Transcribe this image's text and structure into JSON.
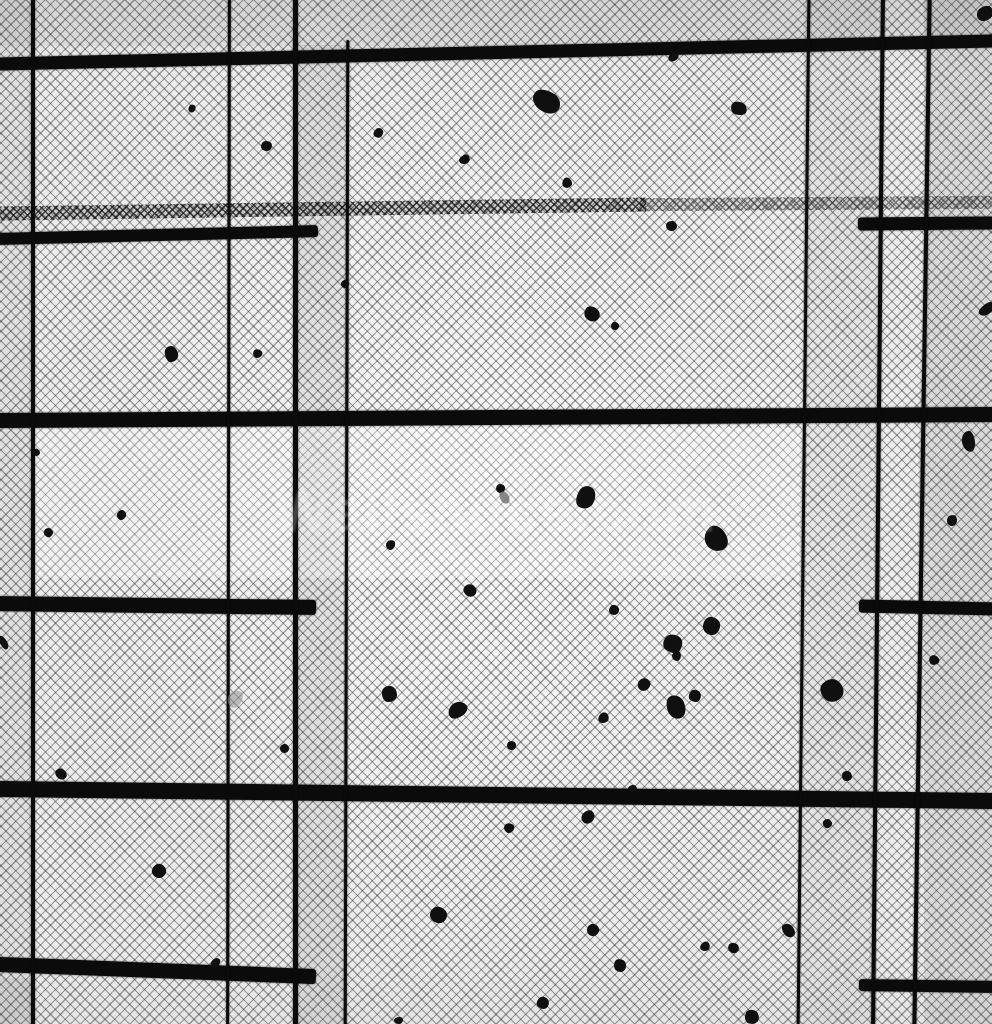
{
  "meta": {
    "description": "Black-and-white photograph looking up at a fine wire insect-screen ceiling with a grid of dark metal frame bars; scattered leaf and debris fragments rest on the mesh",
    "style": "monochrome photograph"
  },
  "palette": {
    "mesh_background": "#ececec",
    "mesh_line": "#2a2a2a",
    "bar": "#0b0b0b",
    "debris": "#101010",
    "debris_gray": "#7a7a7a",
    "watermark": "#ffffff"
  },
  "watermark": {
    "text": "Wallsauce.com",
    "opacity": 0.22
  },
  "frame": {
    "horizontal_bars": [
      {
        "x": -4,
        "y": 46,
        "w": 1000,
        "h": 13,
        "angle": -1.33
      },
      {
        "x": -4,
        "y": 229,
        "w": 322,
        "h": 12,
        "angle": -1.4
      },
      {
        "x": 858,
        "y": 217,
        "w": 140,
        "h": 13,
        "angle": -0.4
      },
      {
        "x": -4,
        "y": 409.5,
        "w": 1000,
        "h": 15,
        "angle": -0.35
      },
      {
        "x": -4,
        "y": 597.5,
        "w": 320,
        "h": 15,
        "angle": 0.7
      },
      {
        "x": 859,
        "y": 600.5,
        "w": 140,
        "h": 13,
        "angle": 1.2
      },
      {
        "x": -4,
        "y": 787,
        "w": 1000,
        "h": 16,
        "angle": 0.7
      },
      {
        "x": -4,
        "y": 962.5,
        "w": 320,
        "h": 15,
        "angle": 2.2
      },
      {
        "x": 859,
        "y": 980,
        "w": 140,
        "h": 12,
        "angle": 0.8
      }
    ],
    "vertical_bars": [
      {
        "x": 31,
        "y": -4,
        "w": 3.5,
        "h": 1032,
        "angle": 0
      },
      {
        "x": 226.5,
        "y": -4,
        "w": 3,
        "h": 1032,
        "angle": 0.1
      },
      {
        "x": 292.5,
        "y": -4,
        "w": 5,
        "h": 1032,
        "angle": 0
      },
      {
        "x": 345,
        "y": 40,
        "w": 3,
        "h": 988,
        "angle": 0.15
      },
      {
        "x": 802,
        "y": -4,
        "w": 3,
        "h": 1032,
        "angle": 0.6
      },
      {
        "x": 876,
        "y": -4,
        "w": 4,
        "h": 1032,
        "angle": 0.55
      },
      {
        "x": 920,
        "y": -4,
        "w": 3.5,
        "h": 1032,
        "angle": 0.85
      }
    ],
    "seam_segments": [
      {
        "x": -4,
        "y": 202,
        "w": 650,
        "h": 14,
        "angle": -0.8,
        "o": 0.9
      },
      {
        "x": 640,
        "y": 197,
        "w": 356,
        "h": 13,
        "angle": -0.4,
        "o": 0.6
      }
    ]
  },
  "panels": [
    {
      "x": 0,
      "y": 0,
      "w": 33,
      "h": 1024,
      "c": "rgba(0,0,0,0.05)"
    },
    {
      "x": 295,
      "y": 45,
      "w": 52,
      "h": 979,
      "c": "rgba(0,0,0,0.07)"
    },
    {
      "x": 803,
      "y": 0,
      "w": 74,
      "h": 1024,
      "c": "rgba(0,0,0,0.04)"
    },
    {
      "x": 924,
      "y": 0,
      "w": 68,
      "h": 1024,
      "c": "rgba(0,0,0,0.08)"
    },
    {
      "x": 0,
      "y": 0,
      "w": 992,
      "h": 46,
      "c": "rgba(0,0,0,0.05)"
    },
    {
      "x": 33,
      "y": 428,
      "w": 770,
      "h": 150,
      "c": "rgba(255,255,255,0.28)"
    },
    {
      "x": 0,
      "y": 978,
      "w": 33,
      "h": 46,
      "c": "rgba(0,0,0,0.06)"
    }
  ],
  "debris": [
    {
      "x": 188,
      "y": 105,
      "w": 8,
      "h": 7
    },
    {
      "x": 261,
      "y": 141,
      "w": 11,
      "h": 10
    },
    {
      "x": 374,
      "y": 128,
      "w": 9,
      "h": 10
    },
    {
      "x": 459,
      "y": 155,
      "w": 11,
      "h": 9
    },
    {
      "x": 532,
      "y": 91,
      "w": 29,
      "h": 21
    },
    {
      "x": 668,
      "y": 53,
      "w": 11,
      "h": 8
    },
    {
      "x": 731,
      "y": 102,
      "w": 16,
      "h": 13
    },
    {
      "x": 562,
      "y": 178,
      "w": 10,
      "h": 10
    },
    {
      "x": 666,
      "y": 221,
      "w": 11,
      "h": 10
    },
    {
      "x": 978,
      "y": 5,
      "w": 14,
      "h": 17
    },
    {
      "x": 165,
      "y": 346,
      "w": 13,
      "h": 16
    },
    {
      "x": 253,
      "y": 349,
      "w": 9,
      "h": 9
    },
    {
      "x": 341,
      "y": 280,
      "w": 8,
      "h": 8
    },
    {
      "x": 117,
      "y": 510,
      "w": 9,
      "h": 10
    },
    {
      "x": 44,
      "y": 528,
      "w": 9,
      "h": 9
    },
    {
      "x": 386,
      "y": 540,
      "w": 9,
      "h": 10
    },
    {
      "x": 585,
      "y": 306,
      "w": 14,
      "h": 16
    },
    {
      "x": 611,
      "y": 322,
      "w": 8,
      "h": 8
    },
    {
      "x": 982,
      "y": 300,
      "w": 10,
      "h": 18
    },
    {
      "x": 962,
      "y": 431,
      "w": 13,
      "h": 21
    },
    {
      "x": 496,
      "y": 484,
      "w": 9,
      "h": 9
    },
    {
      "x": 500,
      "y": 491,
      "w": 9,
      "h": 13,
      "c": "#777777",
      "o": 0.85
    },
    {
      "x": 577,
      "y": 486,
      "w": 18,
      "h": 23
    },
    {
      "x": 705,
      "y": 526,
      "w": 22,
      "h": 26
    },
    {
      "x": 947,
      "y": 515,
      "w": 10,
      "h": 11
    },
    {
      "x": 464,
      "y": 584,
      "w": 12,
      "h": 13
    },
    {
      "x": 382,
      "y": 686,
      "w": 15,
      "h": 16
    },
    {
      "x": 450,
      "y": 700,
      "w": 15,
      "h": 20
    },
    {
      "x": 280,
      "y": 744,
      "w": 9,
      "h": 9
    },
    {
      "x": 55,
      "y": 769,
      "w": 12,
      "h": 10
    },
    {
      "x": 0,
      "y": 635,
      "w": 7,
      "h": 15
    },
    {
      "x": 228,
      "y": 690,
      "w": 14,
      "h": 18,
      "c": "#8f8f8f",
      "o": 0.55
    },
    {
      "x": 609,
      "y": 605,
      "w": 10,
      "h": 10
    },
    {
      "x": 703,
      "y": 617,
      "w": 17,
      "h": 18
    },
    {
      "x": 664,
      "y": 634,
      "w": 18,
      "h": 19
    },
    {
      "x": 672,
      "y": 651,
      "w": 9,
      "h": 10
    },
    {
      "x": 638,
      "y": 678,
      "w": 12,
      "h": 13
    },
    {
      "x": 667,
      "y": 695,
      "w": 18,
      "h": 24
    },
    {
      "x": 689,
      "y": 690,
      "w": 12,
      "h": 12
    },
    {
      "x": 598,
      "y": 713,
      "w": 11,
      "h": 10
    },
    {
      "x": 507,
      "y": 741,
      "w": 9,
      "h": 9
    },
    {
      "x": 821,
      "y": 679,
      "w": 22,
      "h": 23
    },
    {
      "x": 842,
      "y": 771,
      "w": 10,
      "h": 10
    },
    {
      "x": 929,
      "y": 655,
      "w": 10,
      "h": 10
    },
    {
      "x": 628,
      "y": 785,
      "w": 9,
      "h": 8
    },
    {
      "x": 582,
      "y": 810,
      "w": 12,
      "h": 14
    },
    {
      "x": 823,
      "y": 819,
      "w": 9,
      "h": 9
    },
    {
      "x": 504,
      "y": 823,
      "w": 10,
      "h": 10
    },
    {
      "x": 152,
      "y": 864,
      "w": 14,
      "h": 14
    },
    {
      "x": 430,
      "y": 907,
      "w": 17,
      "h": 16
    },
    {
      "x": 210,
      "y": 959,
      "w": 11,
      "h": 8
    },
    {
      "x": 394,
      "y": 1017,
      "w": 9,
      "h": 7
    },
    {
      "x": 587,
      "y": 924,
      "w": 12,
      "h": 12
    },
    {
      "x": 614,
      "y": 959,
      "w": 12,
      "h": 13
    },
    {
      "x": 537,
      "y": 997,
      "w": 12,
      "h": 12
    },
    {
      "x": 700,
      "y": 942,
      "w": 10,
      "h": 9
    },
    {
      "x": 728,
      "y": 943,
      "w": 11,
      "h": 10
    },
    {
      "x": 783,
      "y": 923,
      "w": 11,
      "h": 15
    },
    {
      "x": 745,
      "y": 1010,
      "w": 14,
      "h": 14
    },
    {
      "x": 33,
      "y": 449,
      "w": 7,
      "h": 7
    }
  ]
}
